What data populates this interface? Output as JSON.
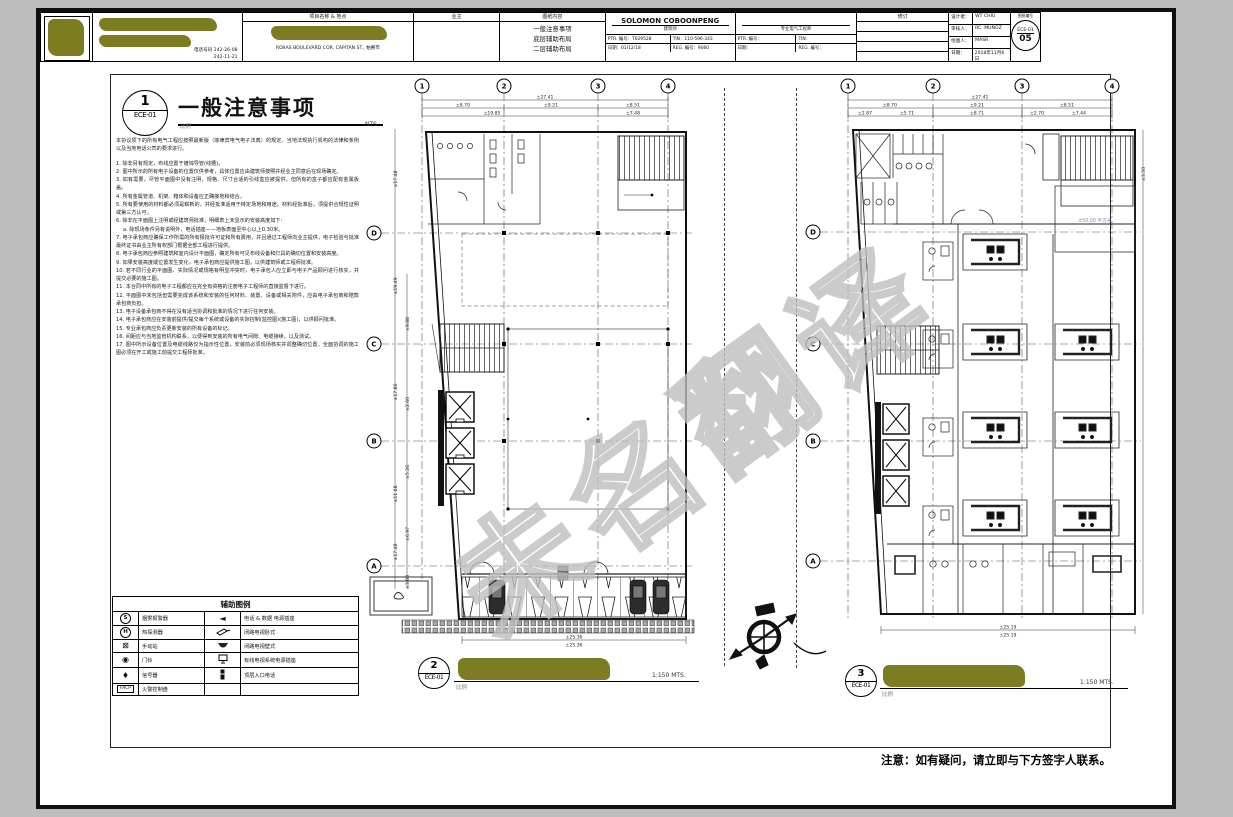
{
  "watermark": "未名翻译",
  "general_notes": {
    "num": "1",
    "sheet": "ECE-01",
    "title": "一般注意事项",
    "scale_label": "比例",
    "scale": "NTS",
    "intro": "本协议项下的所有电气工程应按照最新版（菲律宾电气电子法典）的规定、当地法规执行机构的法律和条例以及当地电话公司的要求进行。",
    "items": [
      "1. 除非另有规定，布线应置于镀锌导管(线槽)。",
      "2. 图中所示的所有电子设备的位置仅供参考，具体位置应由建筑师按照并经业主同意后在现场确定。",
      "3. 如有需要，尽管平面图中没有注明，规格、尺寸合适的引线盒应被提供，但所有的盒子都应配有金属板盖。",
      "4. 所有金属管道、机架、箱体和设备应正确接地和结合。",
      "5. 所有要使用的材料都必须是崭新的，并经批准适用于特定场地和用途。材料经批准后，须提供合规性证明或第三方认可。",
      "6. 除非在平面图上注明或经建筑师批准，明细表上未显示的安装高度如下：",
      "a. 除现场条件另有说明外，电话插座——地板表面至中心以上0.30米。",
      "7. 电子承包商应确保工作所需的所有报批许可证和所有费用，并且通过工程师向业主提供，电子检验与批准最终证书由业主所有权部门根据全部工程进行提供。",
      "8. 电子承包商应参照建筑和室内设计平面图，确定所有可见布线设备和灯具的确切位置和安装高度。",
      "9. 如果安装高度或位置发生变化，电子承包商应提供施工图，以供建筑师或工程师批准。",
      "10. 若不同行业的平面图、实际情况或规格有明显冲突时，电子承包人应立即与电子产品顾问进行核实，并提交必要的施工图。",
      "11. 本合同中所有的电子工程都应在完全有资格的注册电子工程师的直接监督下进行。",
      "12. 平面图中未包括但需要完成该系统和安装的任何材料、装置、设备或相关附件，应由电子承包商和赔款承包商负担。",
      "13. 电子设备承包商不得在没有适当协调和批准的情况下进行任何安装。",
      "14. 电子承包商应在安装前提供/提交每个系统或设备的实际控制(监控图)(施工图)，以供顾问批准。",
      "15. 专业承包商应负责更新安装的所有设备的标记。",
      "16. 间距应与当地监管机构联系，以便得到安装的所有电气间隙、电缆接续，以及测试。",
      "17. 图中所示设备位置及电缆线路仅为指示性位置，安装前必须现场核实并调整确切位置，全面协调的施工图必须在开工或施工前提交工程师批准。"
    ]
  },
  "legend": {
    "title": "辅助图例",
    "left": [
      {
        "glyph": "S",
        "label": "烟雾报警器"
      },
      {
        "glyph": "H",
        "label": "热探测器"
      },
      {
        "glyph": "⊠",
        "label": "手动站"
      },
      {
        "glyph": "◉",
        "label": "门铃"
      },
      {
        "glyph": "♦",
        "label": "信号器"
      },
      {
        "glyph": "FACP",
        "label": "火警控制盘"
      }
    ],
    "right": [
      {
        "glyph": "◄",
        "label": "电话 & 数据 电源插座"
      },
      {
        "glyph": "",
        "label": "闭路电视卧式"
      },
      {
        "glyph": "",
        "label": "闭路电视壁式"
      },
      {
        "glyph": "",
        "label": "有线电视系统电源插座"
      },
      {
        "glyph": "",
        "label": "顶层入口电话"
      }
    ]
  },
  "plan2": {
    "ref_num": "2",
    "ref_sheet": "ECE-01",
    "scale_label": "比例",
    "scale": "1:150 MTS.",
    "grid_cols": [
      "1",
      "2",
      "3",
      "4"
    ],
    "grid_rows": [
      "D",
      "C",
      "B",
      "A"
    ],
    "dim_total": "±27.41",
    "dims_top": [
      "±8.70",
      "±9.21",
      "±8.51"
    ],
    "dims_top2": [
      "±19.85",
      "±7.48"
    ],
    "dims_left": [
      "±17.48",
      "±19.49",
      "±17.86",
      "±11.68",
      "±17.48"
    ],
    "dims_left2": [
      "±9.88",
      "±2.60",
      "±5.26",
      "±6.97",
      "±3.00"
    ],
    "dims_bottom": [
      "±25.36",
      "±25.36"
    ]
  },
  "plan3": {
    "ref_num": "3",
    "ref_sheet": "ECE-01",
    "scale_label": "比例",
    "scale": "1:150 MTS.",
    "grid_cols": [
      "1",
      "2",
      "3",
      "4"
    ],
    "grid_rows": [
      "D",
      "C",
      "B",
      "A"
    ],
    "dim_total": "±27.41",
    "dims_top": [
      "±8.70",
      "±9.21",
      "±8.51"
    ],
    "dims_top2": [
      "±2.87",
      "±5.71",
      "±8.71",
      "±2.70",
      "±7.44"
    ],
    "dim_right": "±3.50",
    "area_label": "±50.00 平方米",
    "dims_bottom": [
      "±25.19",
      "±25.19"
    ]
  },
  "titleblock": {
    "phone_label": "电话号码 242-26-08",
    "phone2": "242-11-21",
    "project_header": "项目名称 & 地点",
    "project_address": "ROXAS BOULEVARD COR. CAPITAN ST., 帕赛市",
    "owner_header": "业主",
    "content_header": "图纸内容",
    "content_lines": [
      "一般注意事项",
      "底层辅助布局",
      "二层辅助布局"
    ],
    "architect_name": "SOLOMON COBOONPENG",
    "architect_title": "建筑师",
    "ptr_label": "PTR. 编号：",
    "architect_ptr": "T029528",
    "tin_label": "TIN：",
    "architect_tin": "110-596-343",
    "date_label": "日期：",
    "architect_date": "01/12/18",
    "reg_label": "REG. 编号：",
    "architect_reg": "9060",
    "engineer_title": "专业电气工程师",
    "revision_header": "修订",
    "designer_label": "设计者：",
    "designer": "WT CHIU",
    "checker_label": "审核人：",
    "checker": "RC. MUÑOZ",
    "drafter_label": "绘图人：",
    "drafter": "MASR",
    "tb_date_label": "日期：",
    "tb_date": "2018年11月6日",
    "sheetno_header": "图纸编号",
    "sheet_code": "ECE-01",
    "sheet_num": "05"
  },
  "footer_note": "注意：如有疑问，请立即与下方签字人联系。"
}
